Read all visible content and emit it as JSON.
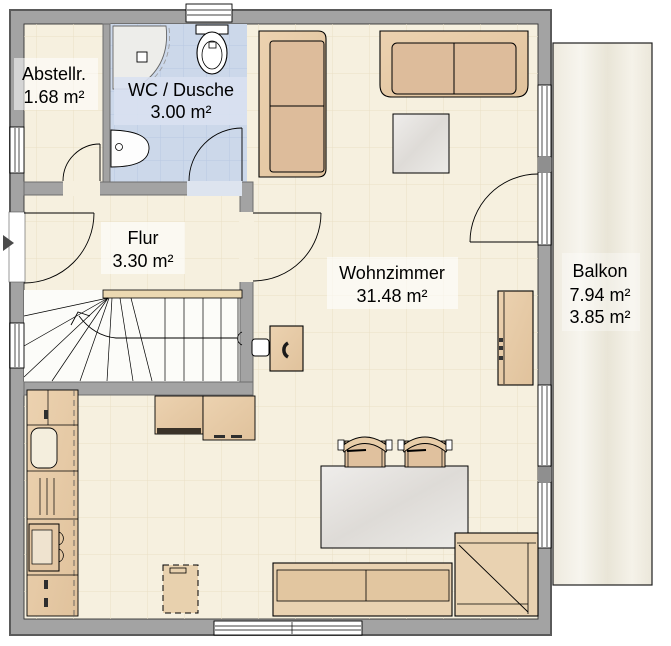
{
  "plan": {
    "title": "Erdgeschoss Grundriss",
    "rooms": [
      {
        "key": "abstellraum",
        "label": "Abstellr.",
        "area": "1.68 m²"
      },
      {
        "key": "wc-dusche",
        "label": "WC / Dusche",
        "area": "3.00 m²"
      },
      {
        "key": "flur",
        "label": "Flur",
        "area": "3.30 m²"
      },
      {
        "key": "wohnzimmer",
        "label": "Wohnzimmer",
        "area": "31.48 m²"
      },
      {
        "key": "balkon",
        "label": "Balkon",
        "area": "7.94 m²",
        "area_secondary": "3.85 m²"
      }
    ],
    "colors": {
      "wall": "#a3a3a3",
      "wall_edge": "#5a5a5a",
      "inner_wall_edge": "#6e6e6e",
      "floor": "#f6f0df",
      "tile_line": "#eadfc6",
      "wc_floor": "#ccd8ea",
      "wc_tile_line": "#b9c8e2",
      "wc_label_bg": "#d9e1f1",
      "stair_floor": "#fcfcf9",
      "wood": "#e8cda9",
      "wood_dark": "#ddbc9b",
      "bench_wood": "#e9d2b1",
      "table": "#e7e5e2",
      "balcony_floor": "#f0ede3",
      "fixture_white": "#f3f3f1",
      "text": "#000000"
    }
  }
}
